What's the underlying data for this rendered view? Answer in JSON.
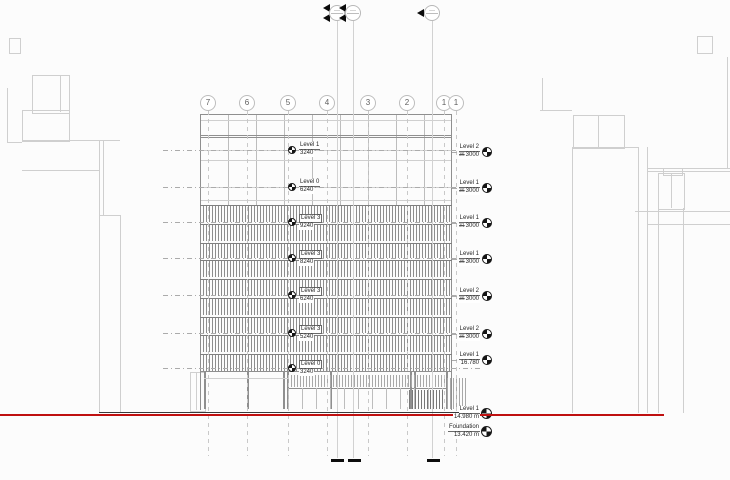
{
  "drawing": {
    "grid_bubbles": [
      {
        "label": "7",
        "x": 208
      },
      {
        "label": "6",
        "x": 247
      },
      {
        "label": "5",
        "x": 288
      },
      {
        "label": "4",
        "x": 327
      },
      {
        "label": "3",
        "x": 368
      },
      {
        "label": "2",
        "x": 407
      },
      {
        "label": "1",
        "x": 444
      },
      {
        "label": "1",
        "x": 456
      }
    ],
    "facade_levels": [
      {
        "name": "Level 1",
        "elevation": "3240",
        "y": 150,
        "boxed": false
      },
      {
        "name": "Level 0",
        "elevation": "6240",
        "y": 187,
        "boxed": false
      },
      {
        "name": "Level 3",
        "elevation": "9240",
        "y": 222,
        "boxed": true
      },
      {
        "name": "Level 3",
        "elevation": "8240",
        "y": 258,
        "boxed": true
      },
      {
        "name": "Level 3",
        "elevation": "6240",
        "y": 295,
        "boxed": true
      },
      {
        "name": "Level 3",
        "elevation": "5240",
        "y": 333,
        "boxed": true
      },
      {
        "name": "Level 0",
        "elevation": "3240",
        "y": 368,
        "boxed": true
      }
    ],
    "right_levels": [
      {
        "name": "Level 2",
        "note": "36",
        "elevation": "3000",
        "y": 152
      },
      {
        "name": "Level 1",
        "note": "36",
        "elevation": "3000",
        "y": 188
      },
      {
        "name": "Level 1",
        "note": "31",
        "elevation": "3000",
        "y": 223
      },
      {
        "name": "Level 1",
        "note": "36",
        "elevation": "3000",
        "y": 259
      },
      {
        "name": "Level 2",
        "note": "36",
        "elevation": "3000",
        "y": 296
      },
      {
        "name": "Level 2",
        "note": "36",
        "elevation": "3000",
        "y": 334
      },
      {
        "name": "Level 1",
        "note": "",
        "elevation": "16.780",
        "y": 360
      }
    ],
    "ground_levels": [
      {
        "name": "Level 1",
        "elevation": "14.980 m",
        "y": 414
      },
      {
        "name": "Foundation",
        "elevation": "13.420 m",
        "y": 432
      }
    ],
    "colors": {
      "ground_line": "#bf1010",
      "context_line": "#cfcfcf",
      "hatch": "#8d8d8d"
    }
  }
}
